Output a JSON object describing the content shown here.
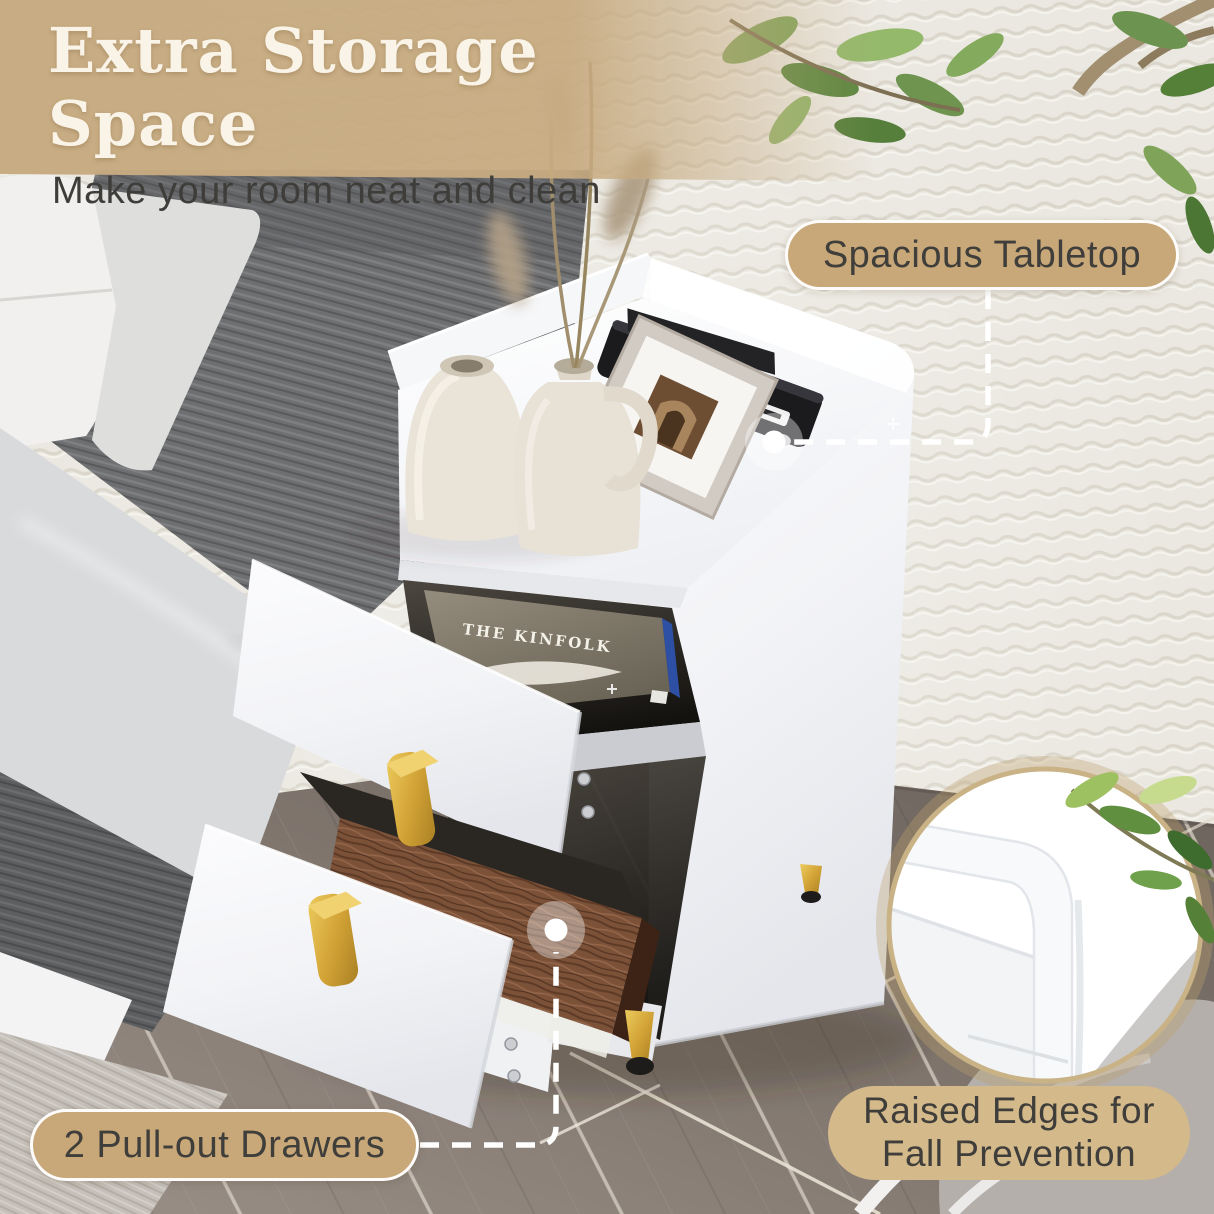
{
  "title": {
    "heading": "Extra Storage Space",
    "subheading": "Make your room neat and clean"
  },
  "callouts": {
    "tabletop": {
      "label": "Spacious Tabletop"
    },
    "drawers": {
      "label": "2 Pull-out Drawers"
    },
    "edges": {
      "label_line1": "Raised Edges for",
      "label_line2": "Fall Prevention"
    }
  },
  "product": {
    "book_cover_title": "THE KINFOLK"
  },
  "colors": {
    "pill_bg": "#c8a878",
    "pill_bg_light": "#d4b98b",
    "pill_text": "#3f3e3b",
    "title_text": "#faf4e8",
    "subtitle_text": "#3e3d3a",
    "connector": "#ffffff",
    "banner_overlay": "#c7ab81",
    "gold_accent": "#d3a437",
    "inset_ring": "#c9b286"
  }
}
